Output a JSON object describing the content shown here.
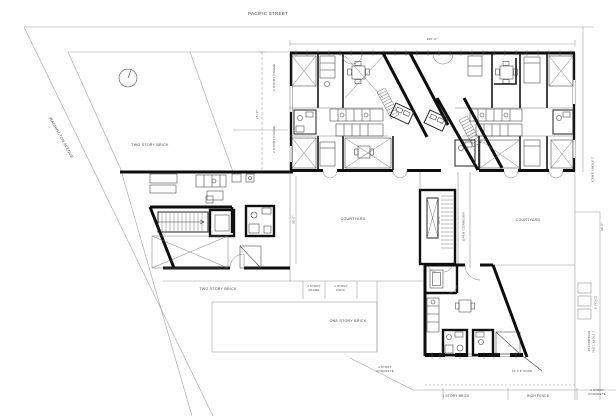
{
  "drawing": {
    "streets": {
      "top": "PACIFIC STREET",
      "side": "WASHINGTON AVENUE"
    },
    "labels": {
      "lot_building": "TWO STORY BRICK",
      "mid_building": "TWO STORY BRICK",
      "one_story_brick": "ONE STORY BRICK",
      "one_story_brick_bottom": "1 STORY BRICK",
      "high_fence": "HIGH FENCE",
      "frame_small_l1": "1 STORY",
      "frame_small_l2": "FRAME",
      "conc_small_l1": "1 STORY",
      "conc_small_l2": "CONC.",
      "concrete_left_l1": "1 STORY",
      "concrete_left_l2": "CONCRETE",
      "concrete_right_l1": "1 STORY",
      "concrete_right_l2": "CONCRETE",
      "two_story_frame_upper": "2 STORY FRAME",
      "two_story_frame_lower": "2 STORY FRAME",
      "two_story_brick_right": "2 STORY BRICK",
      "basement_l1": "BASEMENT AT",
      "basement_l2": "1 STORY CONC",
      "courtyard_left": "COURTYARD",
      "courtyard_right": "COURTYARD",
      "open_corridor": "OPEN CORRIDOR",
      "door_note": "12' X 8' DOOR",
      "fence_note": "6' FENCE"
    },
    "dimensions": {
      "building_width": "160'-0\"",
      "lot_depth": "25'-0\"",
      "courtyard_left_depth": "32'-0\"",
      "courtyard_mid_depth": "32'-0\"",
      "rear_yard_depth": "32'-0\""
    },
    "colors": {
      "paper": "#ffffff",
      "wall_ink": "#111111",
      "line_gray": "#8f8f8f"
    }
  }
}
